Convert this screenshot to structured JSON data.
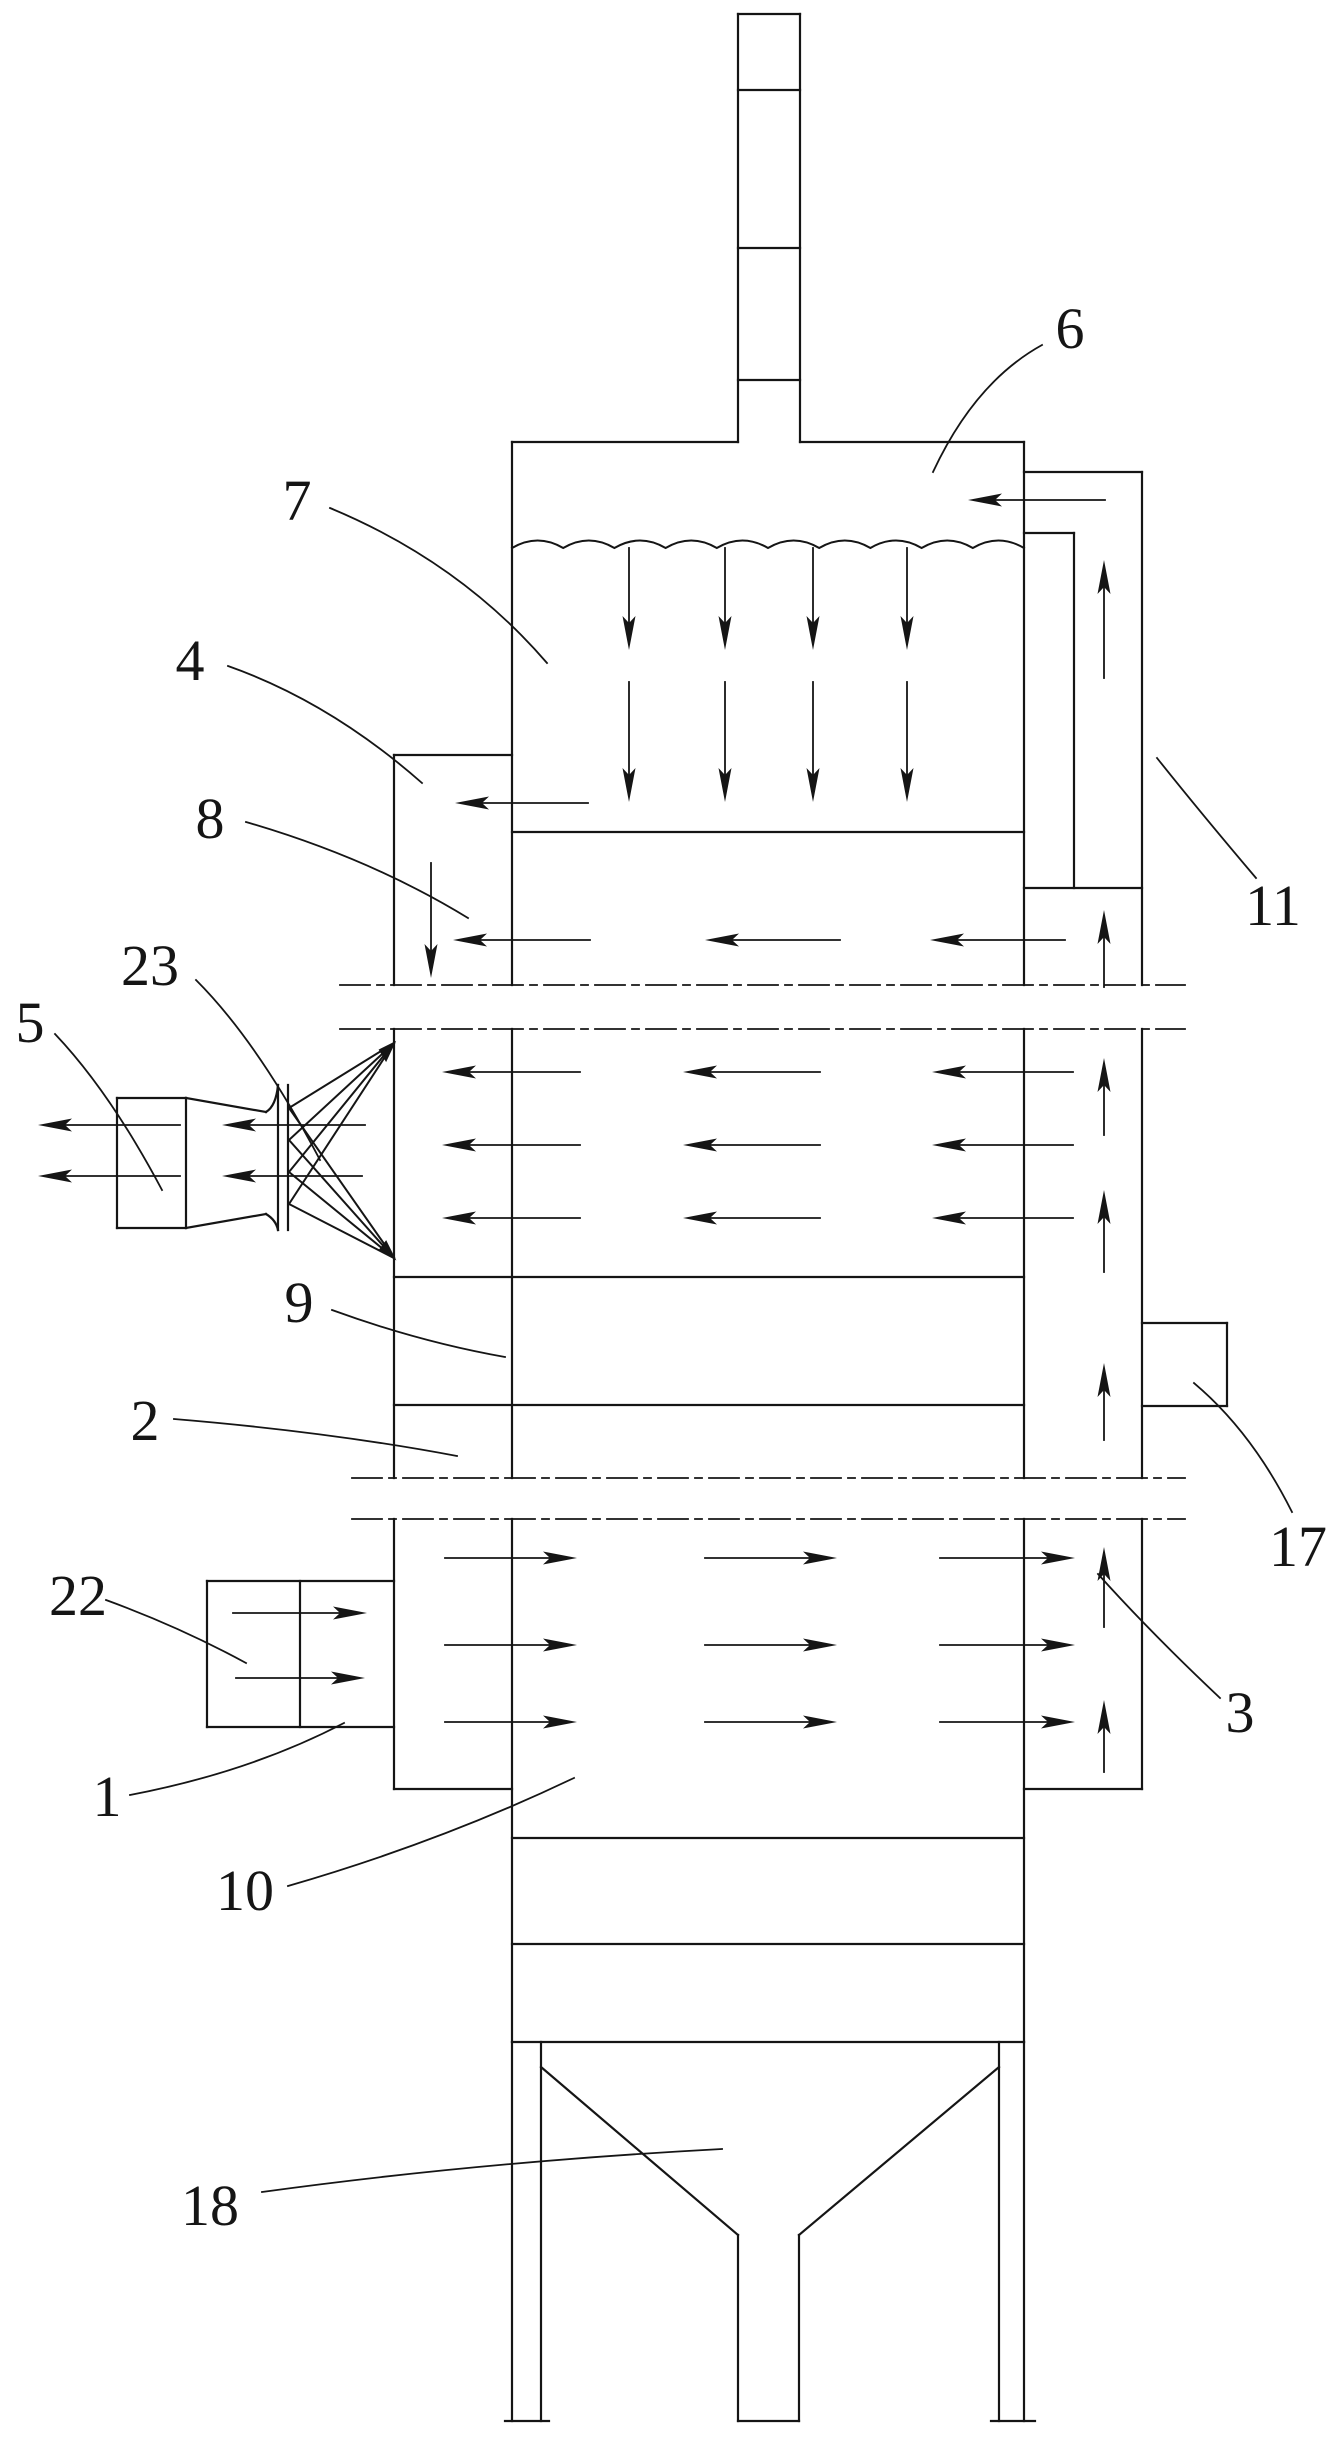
{
  "figure": {
    "kind": "patent-line-drawing",
    "description": "Sectioned vertical scrubbing tower with chimney, spray section, nozzle assembly, side riser duct, inlet box and discharge hopper",
    "ink_color": "#151515",
    "background_color": "#ffffff"
  },
  "labels": [
    {
      "text": "6",
      "x": 1070,
      "y": 348,
      "leader": "M1042,345 Q975,382 933,472"
    },
    {
      "text": "7",
      "x": 297,
      "y": 520,
      "leader": "M330,508 Q460,562 547,663"
    },
    {
      "text": "4",
      "x": 190,
      "y": 680,
      "leader": "M228,666 Q330,702 422,783"
    },
    {
      "text": "8",
      "x": 210,
      "y": 838,
      "leader": "M246,822 Q370,858 468,918"
    },
    {
      "text": "23",
      "x": 150,
      "y": 985,
      "leader": "M196,980 Q258,1042 320,1160"
    },
    {
      "text": "5",
      "x": 30,
      "y": 1042,
      "leader": "M55,1034 Q110,1092 162,1190"
    },
    {
      "text": "11",
      "x": 1273,
      "y": 925,
      "leader": "M1256,878 Q1200,812 1157,758"
    },
    {
      "text": "9",
      "x": 299,
      "y": 1322,
      "leader": "M332,1310 Q420,1342 505,1357"
    },
    {
      "text": "2",
      "x": 145,
      "y": 1440,
      "leader": "M174,1419 Q330,1432 457,1456"
    },
    {
      "text": "17",
      "x": 1298,
      "y": 1566,
      "leader": "M1292,1512 Q1252,1432 1194,1383"
    },
    {
      "text": "22",
      "x": 78,
      "y": 1615,
      "leader": "M106,1600 Q180,1627 246,1663"
    },
    {
      "text": "1",
      "x": 107,
      "y": 1816,
      "leader": "M130,1795 Q250,1772 344,1723"
    },
    {
      "text": "10",
      "x": 245,
      "y": 1910,
      "leader": "M288,1886 Q440,1842 574,1778"
    },
    {
      "text": "18",
      "x": 210,
      "y": 2225,
      "leader": "M262,2192 Q480,2162 722,2149"
    },
    {
      "text": "3",
      "x": 1240,
      "y": 1732,
      "leader": "M1220,1698 Q1150,1632 1098,1574"
    }
  ]
}
